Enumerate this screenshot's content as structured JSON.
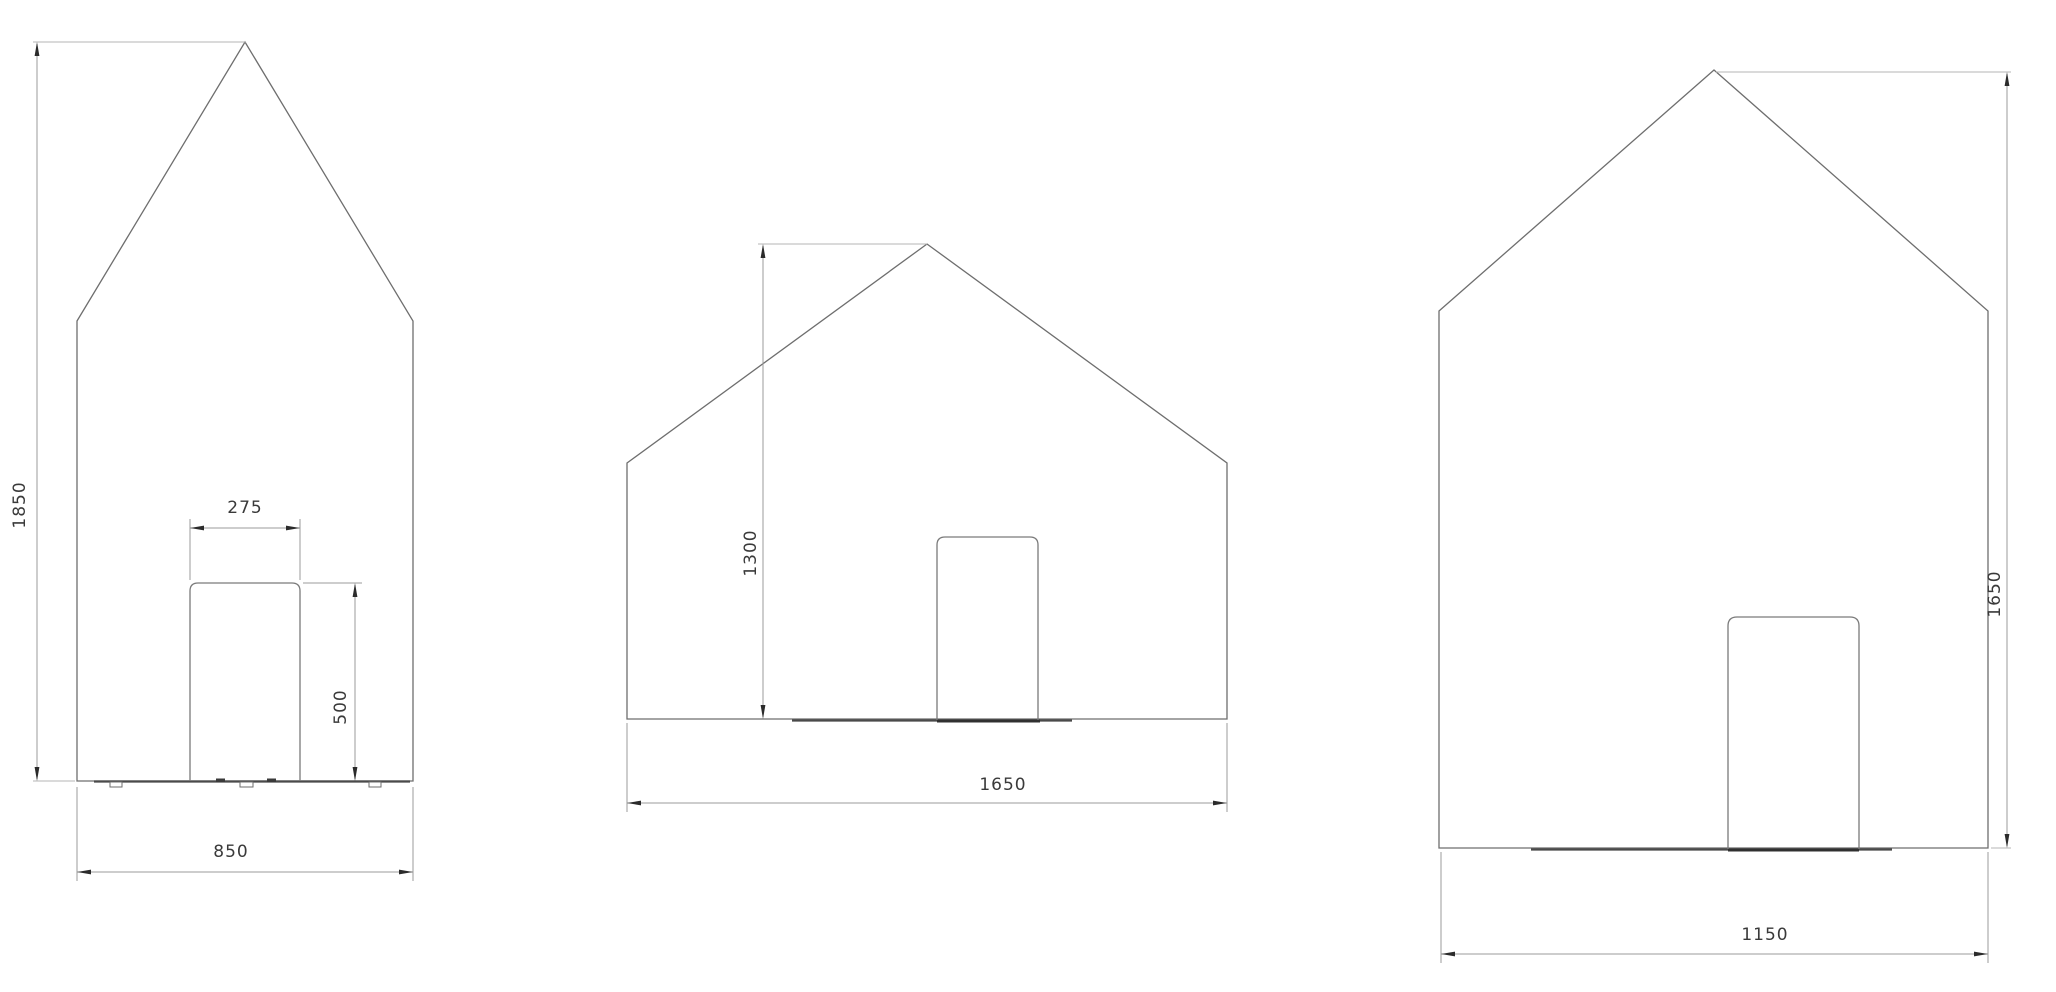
{
  "background_color": "#ffffff",
  "palette": {
    "outline": "#6e6e6e",
    "dimension_line": "#9b9b9b",
    "extension_line": "#b5b5b5",
    "arrowhead": "#2b2b2b",
    "floor_line": "#4a4a4a",
    "label_text": "#3a3a3a"
  },
  "drawings": [
    {
      "name": "house-elevation-small",
      "overall_height": "1850",
      "overall_width": "850",
      "door_width": "275",
      "door_height": "500"
    },
    {
      "name": "house-elevation-medium",
      "overall_height": "1300",
      "overall_width": "1650"
    },
    {
      "name": "house-elevation-large",
      "overall_height": "1650",
      "overall_width": "1150"
    }
  ]
}
